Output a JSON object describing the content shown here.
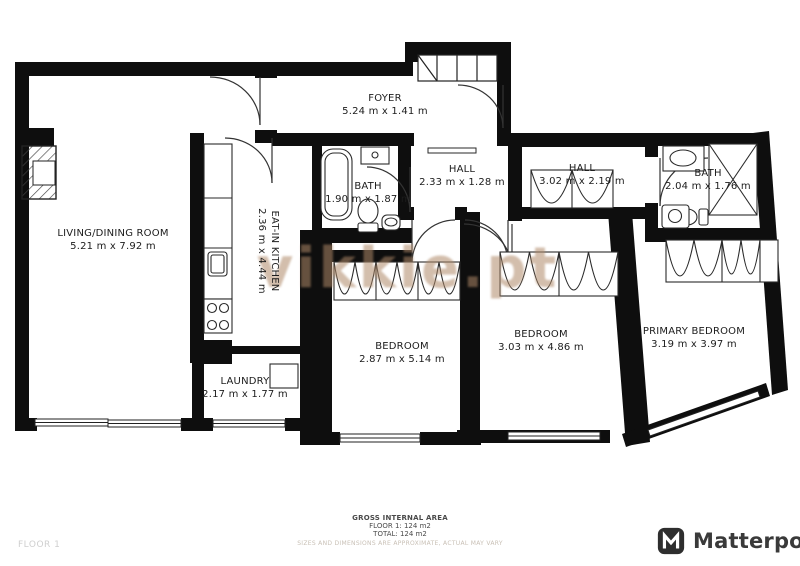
{
  "plan": {
    "floor_label": "FLOOR 1",
    "rooms": [
      {
        "name": "LIVING/DINING ROOM",
        "dims": "5.21 m x 7.92 m"
      },
      {
        "name": "FOYER",
        "dims": "5.24 m x 1.41 m"
      },
      {
        "name": "EAT-IN KITCHEN",
        "dims": "2.36 m x 4.44 m"
      },
      {
        "name": "BATH",
        "dims": "1.90 m x 1.87 m"
      },
      {
        "name": "HALL",
        "dims": "2.33 m x 1.28 m"
      },
      {
        "name": "HALL",
        "dims": "3.02 m x 2.19 m"
      },
      {
        "name": "BATH",
        "dims": "2.04 m x 1.76 m"
      },
      {
        "name": "LAUNDRY",
        "dims": "2.17 m x 1.77 m"
      },
      {
        "name": "BEDROOM",
        "dims": "2.87 m x 5.14 m"
      },
      {
        "name": "BEDROOM",
        "dims": "3.03 m x 4.86 m"
      },
      {
        "name": "PRIMARY BEDROOM",
        "dims": "3.19 m x 3.97 m"
      }
    ]
  },
  "watermark": {
    "text": "vikkie.pt",
    "color": "#af8868"
  },
  "footer": {
    "area_title": "GROSS INTERNAL AREA",
    "floor_area": "FLOOR 1: 124 m2",
    "total_area": "TOTAL: 124 m2",
    "disclaimer": "SIZES AND DIMENSIONS ARE APPROXIMATE, ACTUAL MAY VARY"
  },
  "branding": {
    "logo_text": "Matterport"
  },
  "colors": {
    "wall": "#0e0e0e",
    "fixture_line": "#2a2a2a",
    "footer_gray": "#cfcfcf"
  }
}
